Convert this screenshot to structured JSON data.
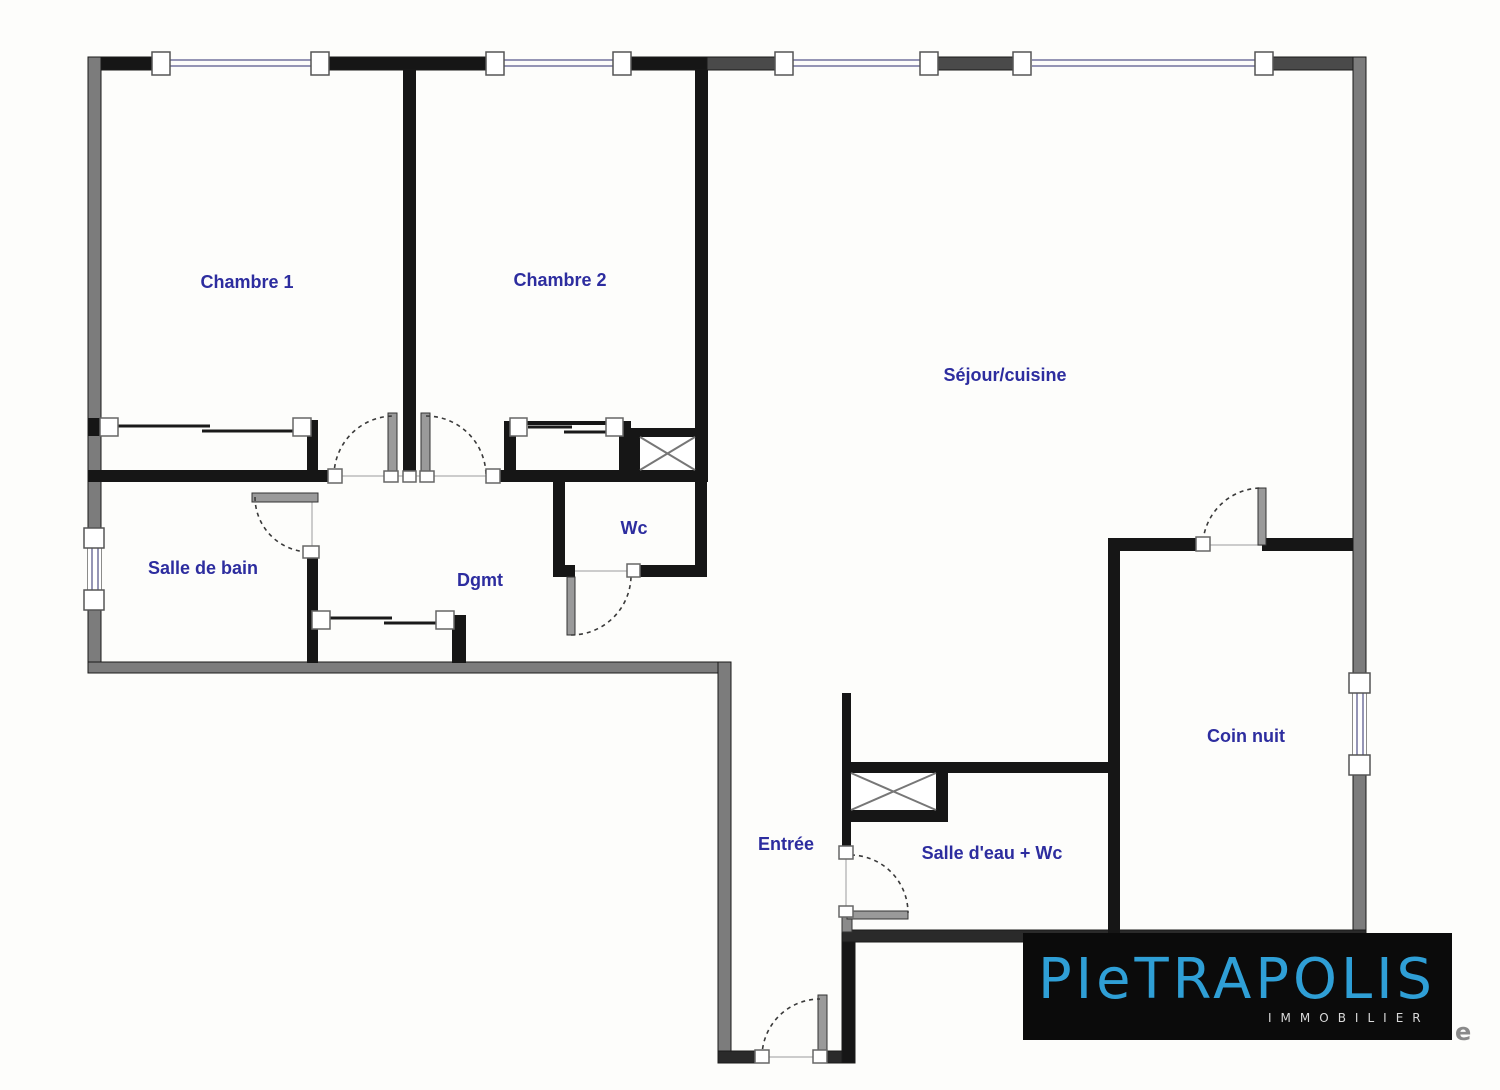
{
  "plan": {
    "label_color": "#2d2d9f",
    "rooms": [
      {
        "label": "Chambre 1"
      },
      {
        "label": "Chambre 2"
      },
      {
        "label": "Séjour/cuisine"
      },
      {
        "label": "Salle de bain"
      },
      {
        "label": "Dgmt"
      },
      {
        "label": "Wc"
      },
      {
        "label": "Entrée"
      },
      {
        "label": "Salle d'eau + Wc"
      },
      {
        "label": "Coin nuit"
      }
    ]
  },
  "logo": {
    "brand": "PIeTRAPOLIS",
    "subtitle": "IMMOBILIER",
    "bg": "#0b0b0b",
    "brand_color": "#2f9fd6",
    "subtitle_color": "#d9d9d9"
  },
  "artifact": {
    "text": "e",
    "color": "#8a8a8a"
  }
}
